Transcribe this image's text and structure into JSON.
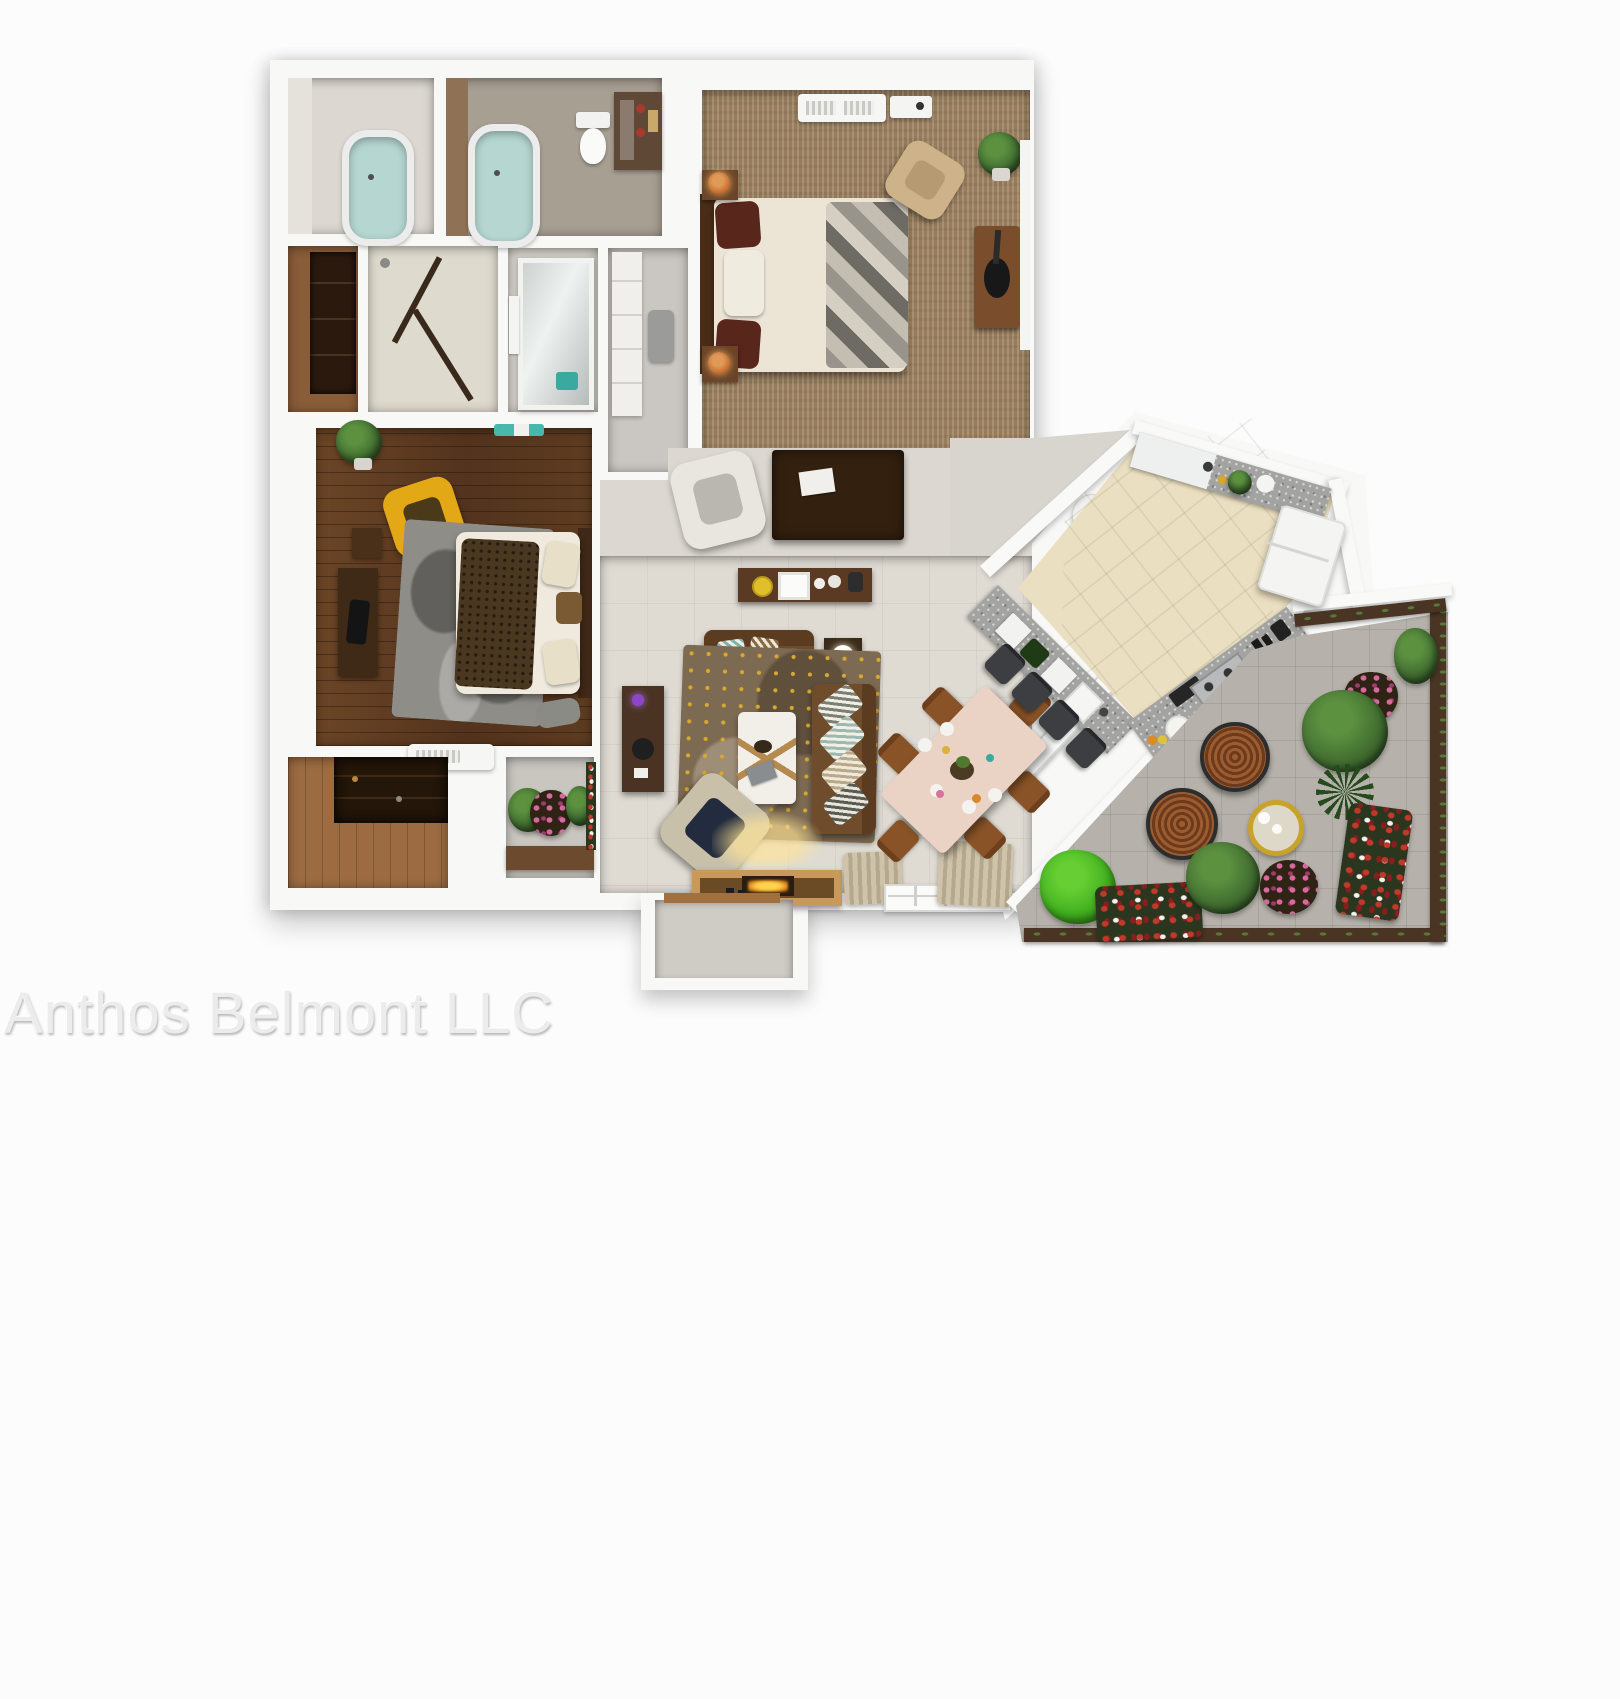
{
  "image": {
    "kind": "3d-floor-plan-rendering",
    "view": "top-down",
    "unit_style": "one-story apartment with angled kitchen and corner patio"
  },
  "watermark": {
    "text": "Anthos Belmont LLC",
    "color": "#ececec"
  },
  "palette": {
    "background": "#fcfcfc",
    "walls": "#f8f8f7",
    "living_tile": "#dfdbd3",
    "master_carpet": "#a08564",
    "bedroom2_hardwood": "#5d3b22",
    "storage_hardwood": "#9c6b41",
    "kitchen_floor": "#eadfc0",
    "counter_granite": "#a3a3a1",
    "patio_stone": "#b6b2ab",
    "bathtub_water": "#b5d6d1",
    "accent_chair_yellow": "#e2a816",
    "sofa_brown": "#6f4c2b",
    "dining_chair_brown": "#8a5327",
    "plant_green": "#3f6a2f",
    "flower_red": "#c0392b",
    "flower_pink": "#d66a9c",
    "tray_table_gold": "#c9a22a",
    "lamp_copper": "#c46a2c"
  },
  "rooms": [
    {
      "id": "bathroom-1",
      "furniture": [
        "bathtub"
      ]
    },
    {
      "id": "master-bathroom",
      "furniture": [
        "bathtub",
        "toilet",
        "vanity"
      ]
    },
    {
      "id": "wardrobe-closet",
      "furniture": [
        "wood-wardrobe"
      ]
    },
    {
      "id": "shower-room",
      "furniture": [
        "glass-shower"
      ]
    },
    {
      "id": "mirror-closet",
      "furniture": [
        "mirror-door",
        "towels",
        "teal-basket"
      ]
    },
    {
      "id": "walk-in-closet",
      "furniture": [
        "shelving",
        "hanging-clothes"
      ]
    },
    {
      "id": "bedroom-2",
      "furniture": [
        "double-bed",
        "yellow-armchair",
        "gray-rug",
        "dresser",
        "plant",
        "wall-ac-unit"
      ]
    },
    {
      "id": "master-bedroom",
      "furniture": [
        "king-bed",
        "two-nightstands",
        "copper-lamps",
        "tan-armchair",
        "dresser-with-guitar",
        "plant",
        "ceiling-vent-unit"
      ]
    },
    {
      "id": "sitting-nook",
      "furniture": [
        "white-armchair",
        "dark-desk"
      ]
    },
    {
      "id": "living-room",
      "furniture": [
        "sofa",
        "loveseat",
        "coffee-table",
        "patterned-rug",
        "console-table",
        "media-console",
        "armchair",
        "fireplace-tv-console",
        "curtained-windows"
      ]
    },
    {
      "id": "dining-area",
      "furniture": [
        "dining-table",
        "six-chairs",
        "table-settings"
      ]
    },
    {
      "id": "kitchen",
      "furniture": [
        "granite-bar-counter",
        "four-bar-stools",
        "gas-stove",
        "range-hood",
        "red-pot",
        "sink-counter",
        "refrigerator",
        "coffee-set",
        "fruit-and-veggies"
      ]
    },
    {
      "id": "entry-corridor",
      "furniture": [
        "plant",
        "round-pedestal"
      ]
    },
    {
      "id": "patio",
      "furniture": [
        "two-rattan-lounge-chairs",
        "gold-tray-table",
        "bushes",
        "flower-beds",
        "planter-walls"
      ]
    },
    {
      "id": "storage-room",
      "furniture": [
        "dark-shelf-unit"
      ]
    },
    {
      "id": "front-garden",
      "furniture": [
        "plants",
        "pink-flowers",
        "planter-box"
      ]
    },
    {
      "id": "entry-porch",
      "furniture": [
        "door-step"
      ]
    }
  ]
}
